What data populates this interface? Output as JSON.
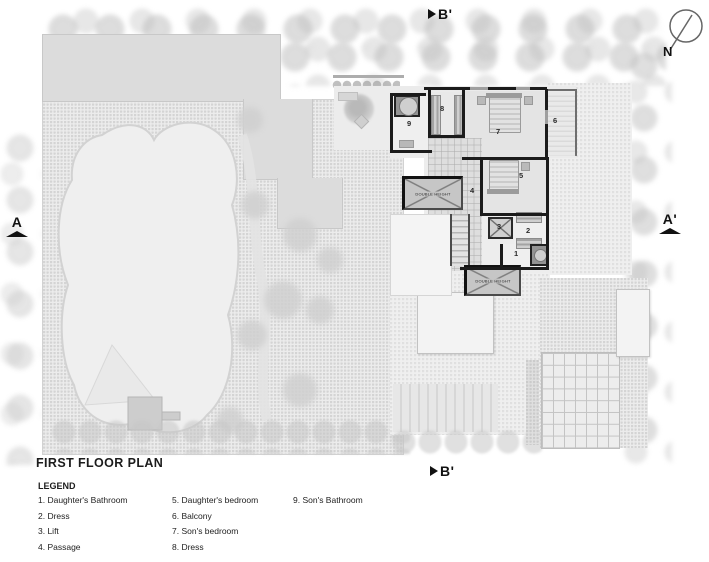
{
  "title": "FIRST FLOOR PLAN",
  "legend": {
    "heading": "LEGEND",
    "col1": [
      "1. Daughter's Bathroom",
      "2. Dress",
      "3. Lift",
      "4. Passage"
    ],
    "col2": [
      "5. Daughter's bedroom",
      "6. Balcony",
      "7. Son's bedroom",
      "8. Dress"
    ],
    "col3": [
      "9. Son's Bathroom"
    ]
  },
  "section_markers": {
    "top": "B'",
    "bottom": "B'",
    "left": "A",
    "right": "A'"
  },
  "compass": {
    "label": "N"
  },
  "plan": {
    "room_numbers": [
      "1",
      "2",
      "3",
      "4",
      "5",
      "6",
      "7",
      "8",
      "9"
    ],
    "double_height_label": "DOUBLE HEIGHT"
  },
  "colors": {
    "wall": "#1b1b1b",
    "slab": "#dcdcdc",
    "lawn": "#efefef",
    "paving": "#ececec",
    "text": "#1a1a1a"
  }
}
